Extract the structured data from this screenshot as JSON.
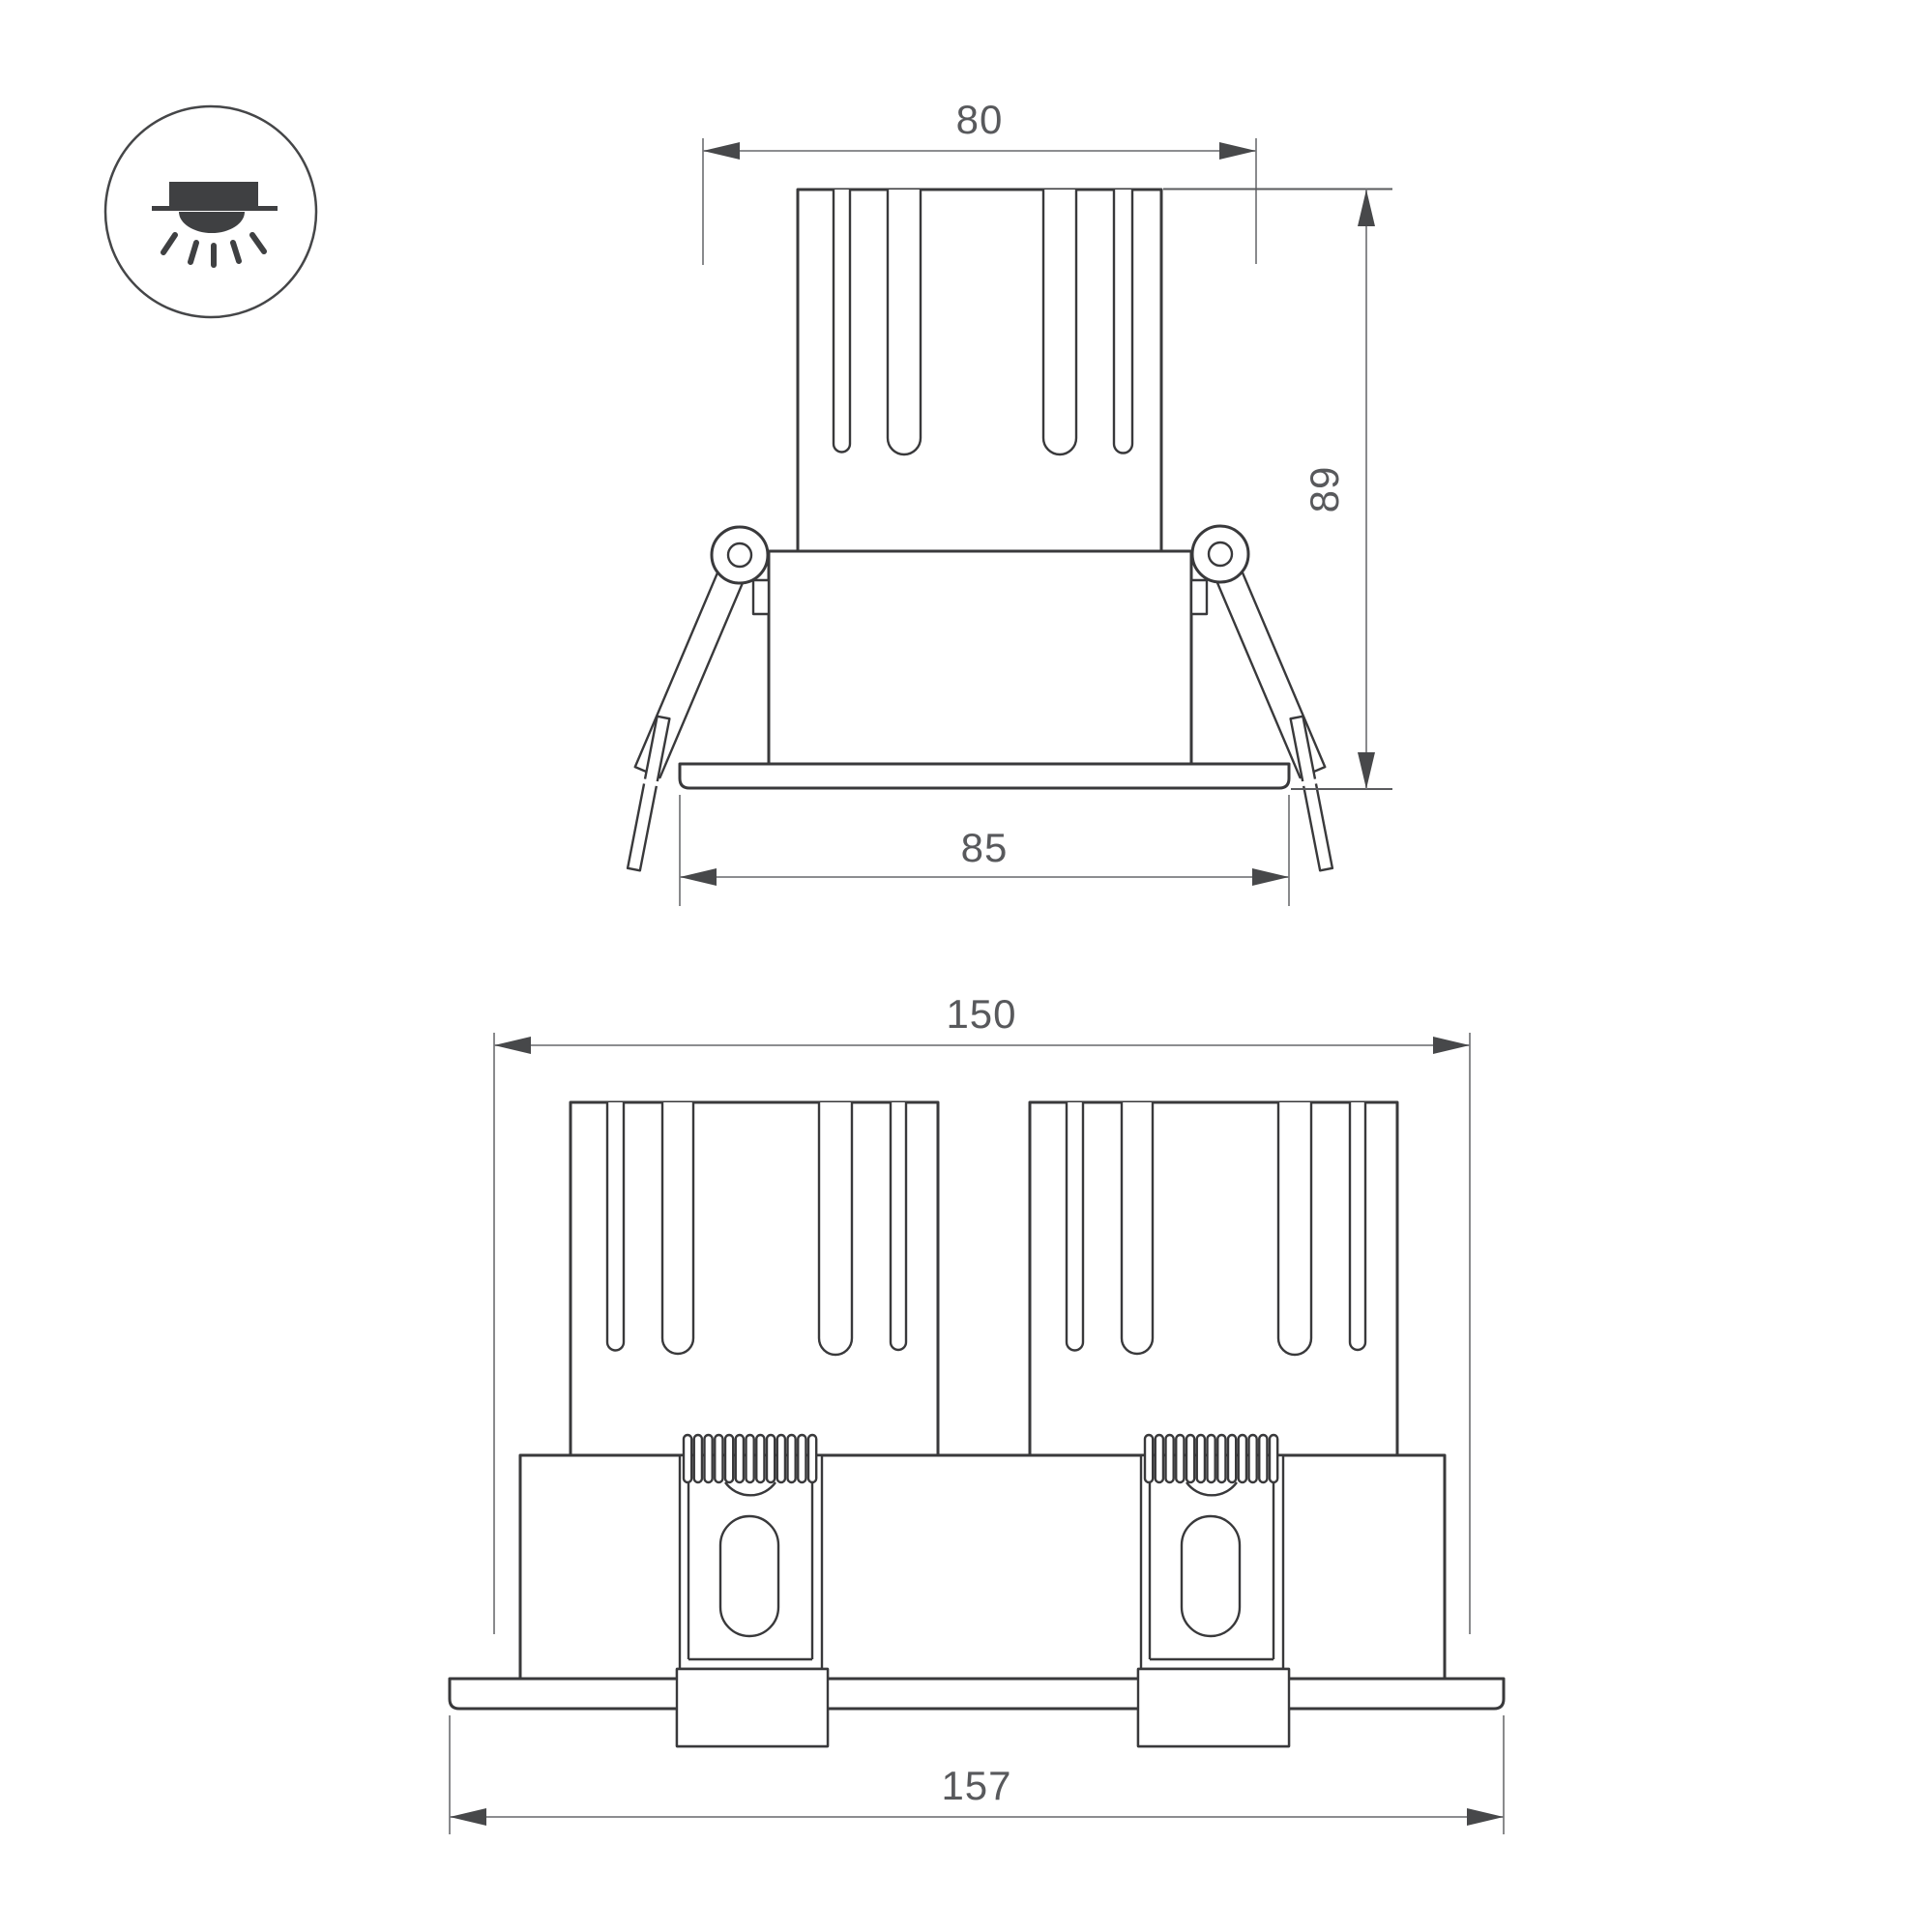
{
  "drawing": {
    "background": "#ffffff",
    "line_color": "#39393b",
    "dim_line_color": "#7c7d80",
    "text_color": "#58595c",
    "icon": {
      "name": "recessed-downlight-mounting-icon"
    },
    "side_view": {
      "label": "single module side view",
      "dim_top_width": "80",
      "dim_height": "89",
      "dim_flange_width": "85"
    },
    "front_view": {
      "label": "twin module front view",
      "dim_body_width": "150",
      "dim_flange_width": "157"
    }
  }
}
